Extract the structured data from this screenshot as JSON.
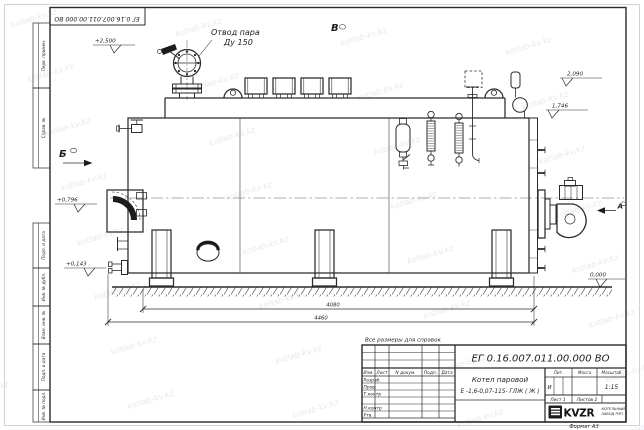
{
  "frame": {
    "doc_number_rotated": "ЕГ 0.16.007.011.00.000  ВО",
    "format_label": "Формат А3",
    "side_columns_top": [
      "Перв. примен.",
      "Справ. №"
    ],
    "side_columns_bottom": [
      "Подп. и дата",
      "Инв. № дубл.",
      "Взам. инв. №",
      "Подп. и дата",
      "Инв. № подл."
    ]
  },
  "drawing": {
    "note": "Все размеры для справок",
    "callout_line1": "Отвод пара",
    "callout_line2": "Ду 150",
    "view_b": "Б",
    "view_v": "В",
    "view_a": "А",
    "elev_2500": "+2,500",
    "elev_0796": "+0,796",
    "elev_0143": "+0,143",
    "elev_0000": "0,000",
    "elev_2090": "2,090",
    "elev_1746": "1,746",
    "dim_4080": "4080",
    "dim_4460": "4460"
  },
  "title_block": {
    "doc_number": "ЕГ 0.16.007.011.00.000  ВО",
    "product_name": "Котел паровой",
    "product_code": "Е -1,6-0,07-115- ГЛЖ ( Ж )",
    "col_izm": "Изм.",
    "col_list": "Лист",
    "col_ndoc": "N докум.",
    "col_podp": "Подп.",
    "col_data": "Дата",
    "row_razrab": "Разраб.",
    "row_prov": "Пров.",
    "row_tkontr": "Т.контр",
    "row_nkontr": "Н.контр",
    "row_utv": "Утв.",
    "lit_header": "Лит.",
    "mass_header": "Масса",
    "scale_header": "Масштаб",
    "lit_value": "И",
    "scale_value": "1:15",
    "sheet_no": "Лист 1",
    "sheets_total": "Листов 2",
    "logo_text": "KVZR",
    "company_line1": "КОТЕЛЬНЫЙ",
    "company_line2": "ЗАВОД РЭП"
  },
  "watermark": {
    "text": "kotlab-kv.kz"
  },
  "colors": {
    "paper": "#ffffff",
    "line": "#2b2b2b",
    "watermark": "#c9d1da"
  }
}
